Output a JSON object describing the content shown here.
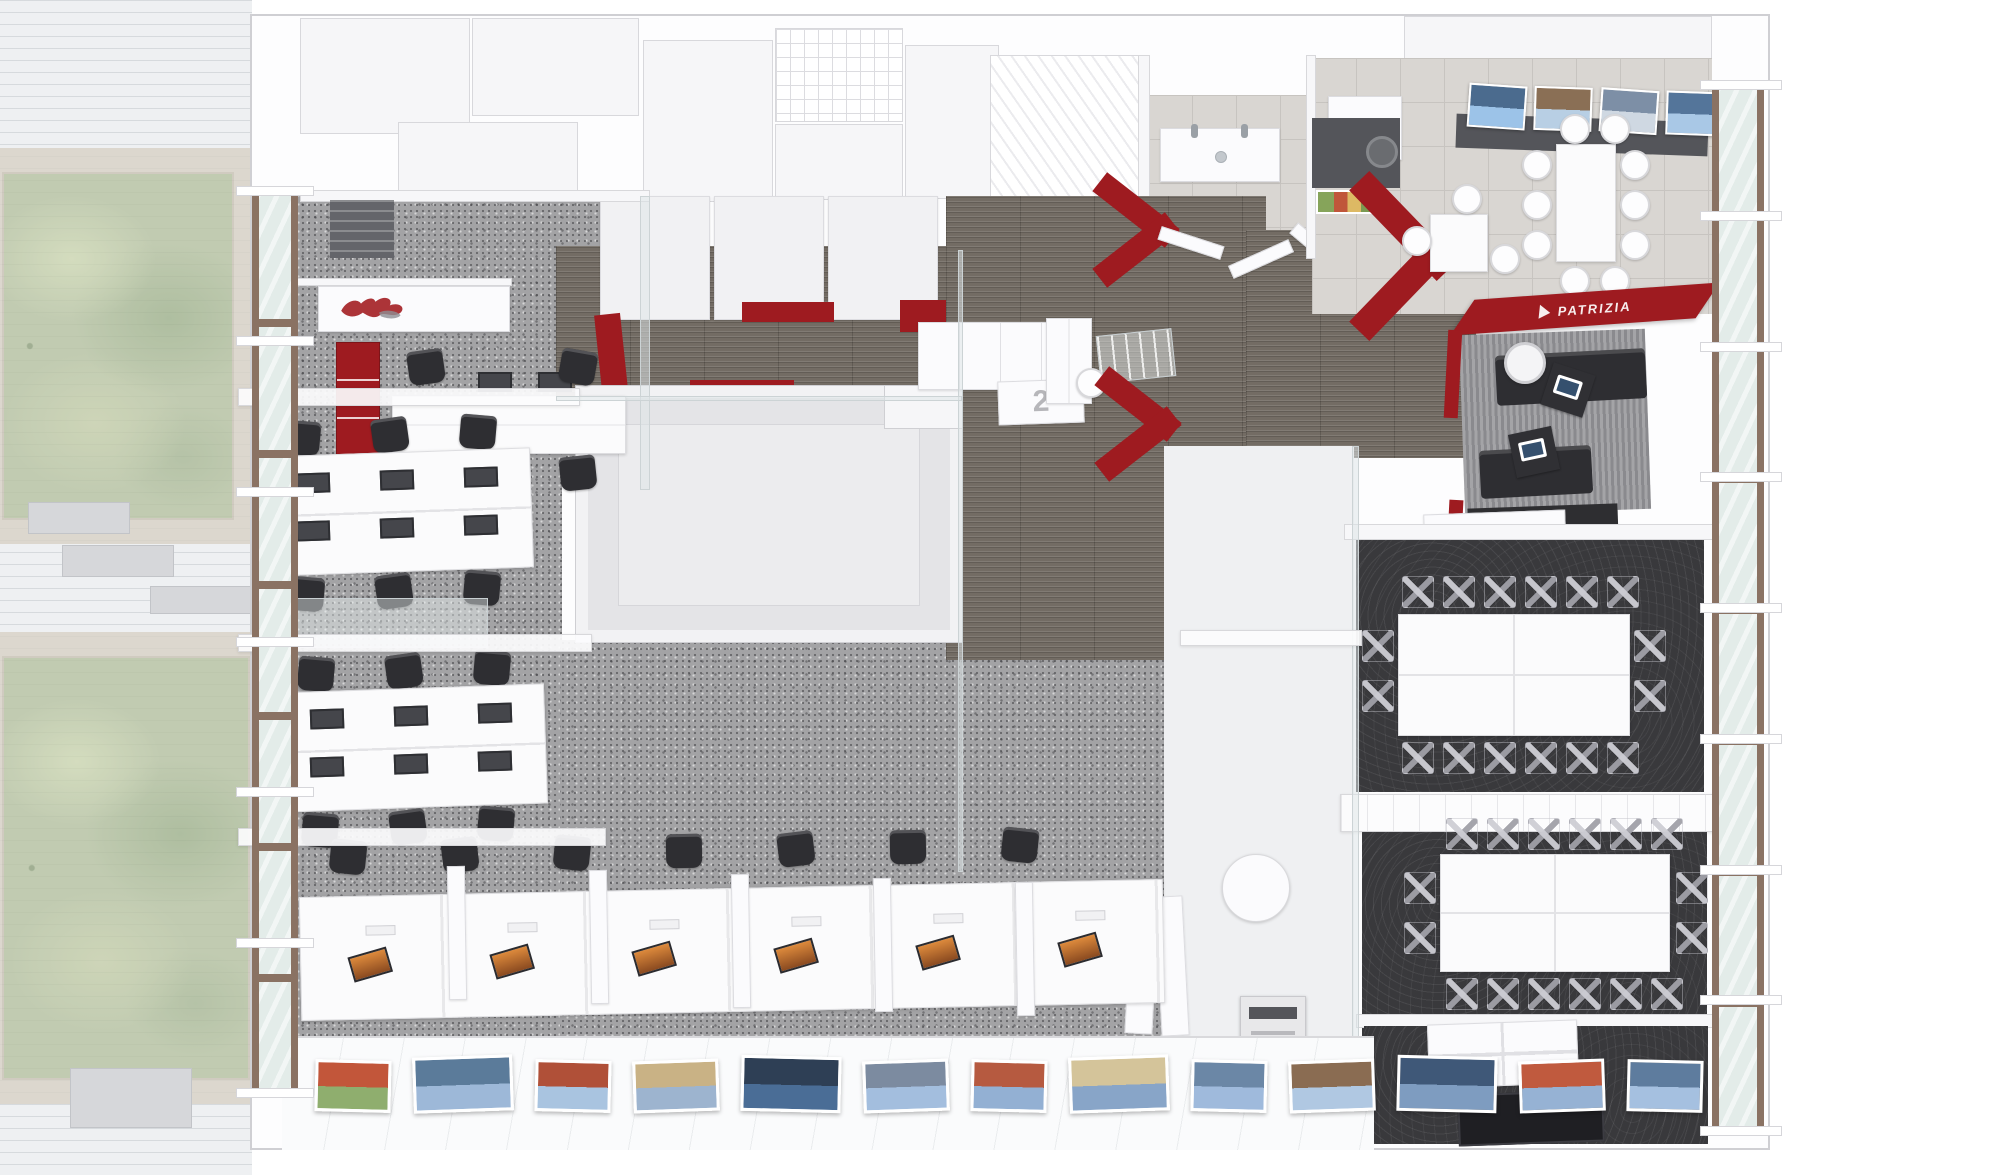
{
  "signage": {
    "logo_text": "PATRIZIA",
    "level_marker": "2"
  },
  "palette": {
    "brand_red": "#9e1b20",
    "red_dark": "#8c181d",
    "carpet": "#a3a3a5",
    "wood": "#736c64",
    "dark_carpet": "#39393c",
    "tile": "#d9d6d2",
    "facade_brown": "#8a7263",
    "glass": "#e3ece9",
    "garden": "#b7c3a2",
    "garden_frame": "#d8d2c6",
    "pavement": "#eef0f2",
    "counter_dark": "#54555a",
    "furniture_black": "#2e2e32",
    "screen_orange": "#dd8a3c"
  },
  "gallery_photos": [
    {
      "subject": "#c2563a",
      "sky": "#8fae6e"
    },
    {
      "subject": "#5b7b9a",
      "sky": "#9db8d8"
    },
    {
      "subject": "#b05038",
      "sky": "#a9c4e0"
    },
    {
      "subject": "#c9b285",
      "sky": "#9db4cf"
    },
    {
      "subject": "#2e3f55",
      "sky": "#4a6d96"
    },
    {
      "subject": "#7c8ba0",
      "sky": "#a3bede"
    },
    {
      "subject": "#b65a40",
      "sky": "#93b0d3"
    },
    {
      "subject": "#d4c49a",
      "sky": "#88a5c8"
    },
    {
      "subject": "#6b87a6",
      "sky": "#9fbadc"
    },
    {
      "subject": "#8a6c52",
      "sky": "#b0c8e2"
    },
    {
      "subject": "#3f5878",
      "sky": "#7e9cc0"
    },
    {
      "subject": "#c05a3e",
      "sky": "#96b2d4"
    },
    {
      "subject": "#5e7c9e",
      "sky": "#a5c0e0"
    }
  ],
  "counter_photos": [
    {
      "subject": "#4b6b8e",
      "sky": "#9cc3e8"
    },
    {
      "subject": "#8a6f55",
      "sky": "#b8cfe4"
    },
    {
      "subject": "#7d8fa6",
      "sky": "#cfd8e2"
    },
    {
      "subject": "#54759a",
      "sky": "#a9c8e6"
    }
  ],
  "counts": {
    "cluster_row_seats": 3,
    "bottom_row_stations": 6,
    "bottom_row_chairs": 7,
    "conference_long_side_seats": 6,
    "conference_short_side_seats": 2,
    "cafe_side_seats": 3,
    "cafe_end_seats": 2,
    "facade_bays_left": 7,
    "facade_bays_right": 9
  }
}
